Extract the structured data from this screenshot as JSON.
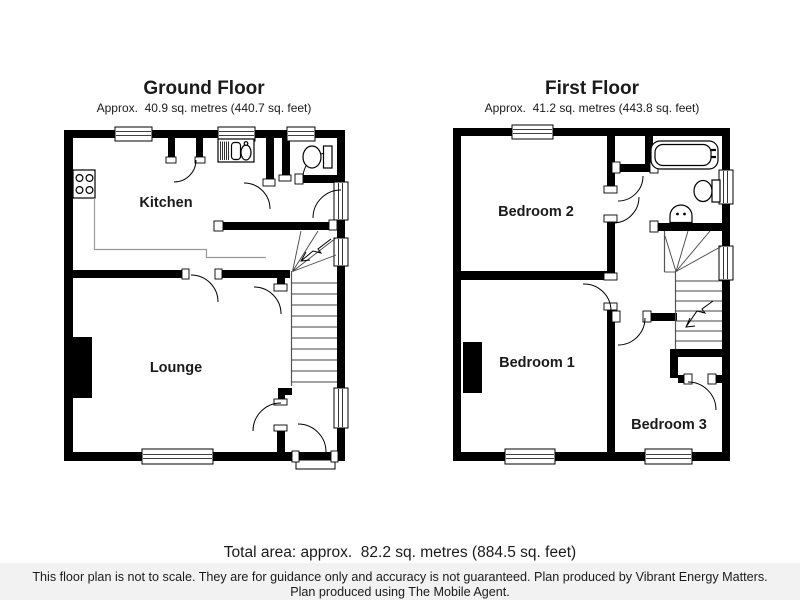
{
  "page": {
    "background": "#ffffff"
  },
  "ground_floor": {
    "title": "Ground Floor",
    "area_label": "Approx.  40.9 sq. metres (440.7 sq. feet)",
    "rooms": {
      "kitchen": "Kitchen",
      "lounge": "Lounge"
    },
    "fixtures": [
      "hob-icon",
      "sink-icon",
      "toilet-icon",
      "stairs-up",
      "chimney-breast"
    ]
  },
  "first_floor": {
    "title": "First Floor",
    "area_label": "Approx.  41.2 sq. metres (443.8 sq. feet)",
    "rooms": {
      "bedroom1": "Bedroom 1",
      "bedroom2": "Bedroom 2",
      "bedroom3": "Bedroom 3"
    },
    "fixtures": [
      "bath-icon",
      "toilet-icon",
      "basin-icon",
      "stairs-up",
      "chimney-breast"
    ]
  },
  "footer": {
    "total_area": "Total area: approx.  82.2 sq. metres (884.5 sq. feet)",
    "disclaimer_line1": "This floor plan is not to scale. They are for guidance only and accuracy is not guaranteed. Plan produced by Vibrant Energy Matters.",
    "disclaimer_line2": "Plan produced using The Mobile Agent."
  },
  "colors": {
    "wall": "#000000",
    "background": "#ffffff",
    "disclaimer_bg": "#f2f2f2",
    "counter_line": "#9a9a9a"
  }
}
